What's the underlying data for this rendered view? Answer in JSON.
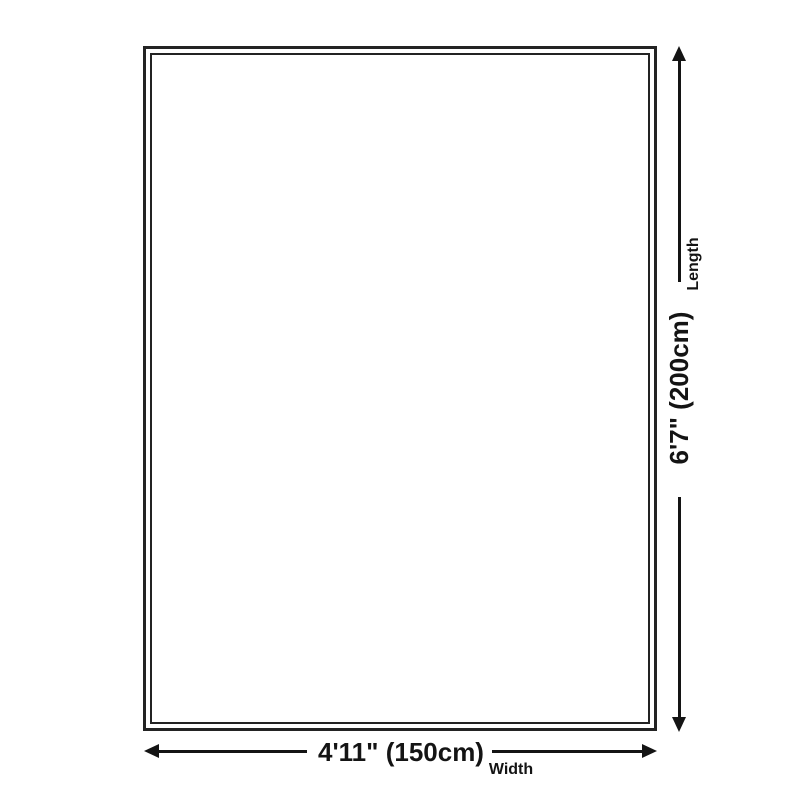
{
  "diagram": {
    "title": "product-size-diagram",
    "length": {
      "value": "6'7\" (200cm)",
      "label": "Length",
      "orientation": "vertical"
    },
    "width": {
      "value": "4'11\" (150cm)",
      "label": "Width",
      "orientation": "horizontal"
    }
  },
  "colors": {
    "background": "#ffffff",
    "outline": "#232323",
    "dimension": "#141414"
  }
}
